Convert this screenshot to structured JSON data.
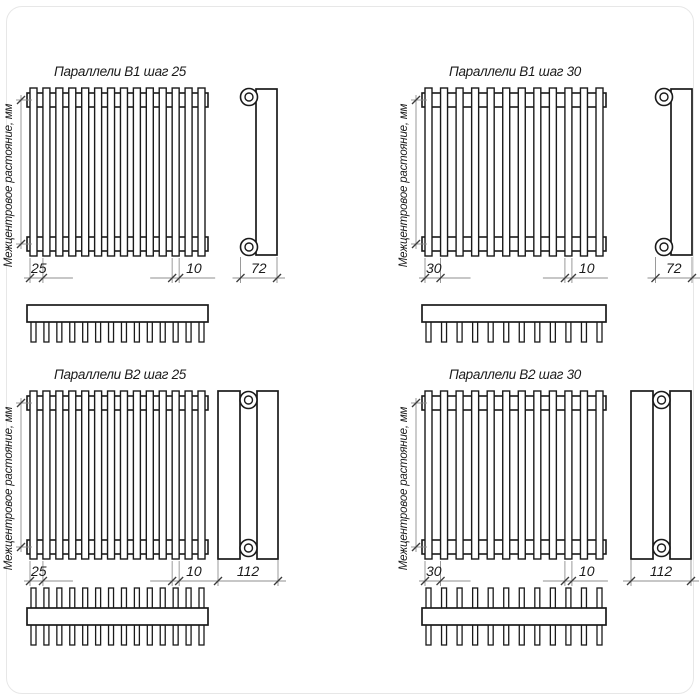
{
  "drawing": {
    "axis_label": "Межцентровое растояние, мм",
    "colors": {
      "line": "#1a1a1a",
      "dim": "#8f8f8f",
      "tick": "#3c3c3c",
      "text": "#1b1b1b",
      "background": "#ffffff"
    },
    "panels": [
      {
        "title": "Параллели В1 шаг 25",
        "rows": 1,
        "slats": 14,
        "dim_pitch": "25",
        "dim_slat": "10",
        "dim_depth": "72"
      },
      {
        "title": "Параллели В1 шаг 30",
        "rows": 1,
        "slats": 12,
        "dim_pitch": "30",
        "dim_slat": "10",
        "dim_depth": "72"
      },
      {
        "title": "Параллели В2 шаг 25",
        "rows": 2,
        "slats": 14,
        "dim_pitch": "25",
        "dim_slat": "10",
        "dim_depth": "112"
      },
      {
        "title": "Параллели В2 шаг 30",
        "rows": 2,
        "slats": 12,
        "dim_pitch": "30",
        "dim_slat": "10",
        "dim_depth": "112"
      }
    ]
  }
}
